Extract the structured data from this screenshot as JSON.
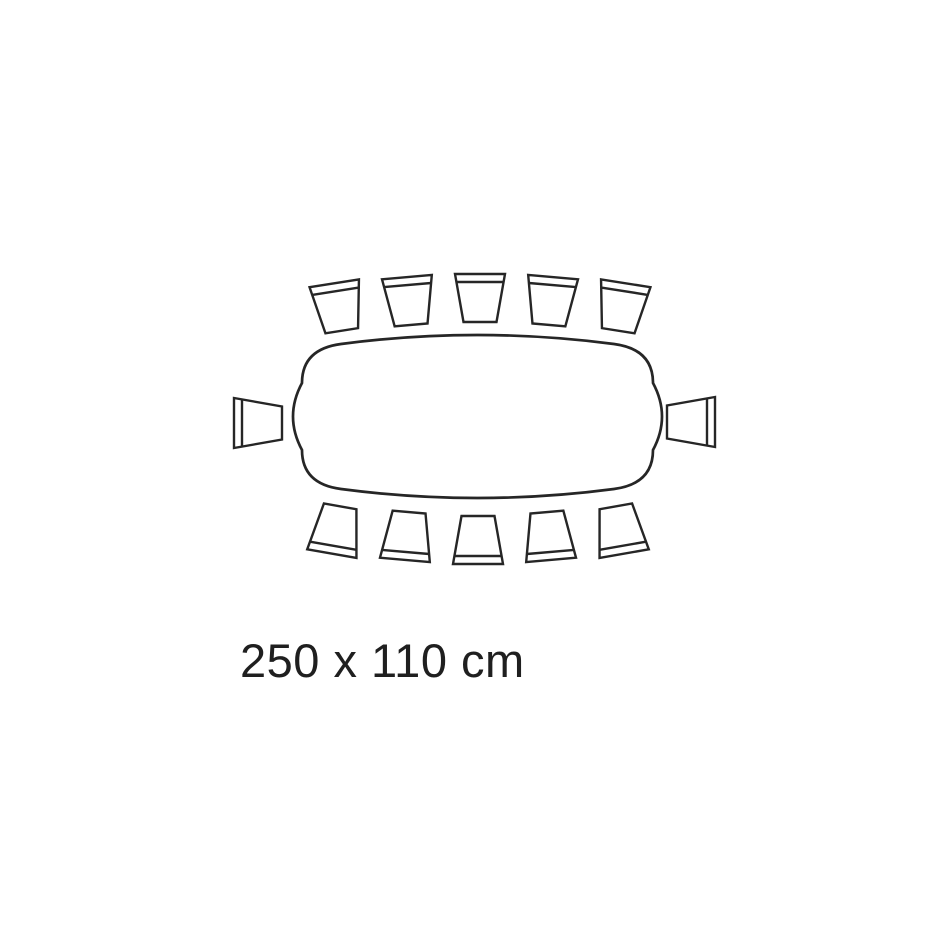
{
  "page": {
    "background": "#ffffff"
  },
  "diagram": {
    "kind": "table-seating-plan-top-view",
    "label": "250 x 110 cm",
    "table_dimensions": {
      "width_cm": 250,
      "depth_cm": 110
    },
    "seat_count": 12,
    "stroke_color": "#262626",
    "fill_color": "#ffffff",
    "table_stroke_width": 2.7,
    "chair_stroke_width": 2.4,
    "table": {
      "left": 293,
      "top": 335,
      "right": 662,
      "bottom": 498,
      "corner_radius": 48,
      "edge_bulge": 9
    },
    "chair": {
      "back_width": 50,
      "front_width": 33,
      "depth": 48,
      "back_band_offset": 8
    },
    "chairs": [
      {
        "id": "top-1",
        "cx": 338,
        "cy": 307,
        "facing": "down",
        "tilt": -9
      },
      {
        "id": "top-2",
        "cx": 409,
        "cy": 301,
        "facing": "down",
        "tilt": -5
      },
      {
        "id": "top-3",
        "cx": 480,
        "cy": 298,
        "facing": "down",
        "tilt": 0
      },
      {
        "id": "top-4",
        "cx": 551,
        "cy": 301,
        "facing": "down",
        "tilt": 5
      },
      {
        "id": "top-5",
        "cx": 622,
        "cy": 307,
        "facing": "down",
        "tilt": 9
      },
      {
        "id": "left",
        "cx": 258,
        "cy": 423,
        "facing": "right",
        "tilt": 0
      },
      {
        "id": "right",
        "cx": 691,
        "cy": 422,
        "facing": "left",
        "tilt": 0
      },
      {
        "id": "bottom-1",
        "cx": 336,
        "cy": 530,
        "facing": "up",
        "tilt": 10
      },
      {
        "id": "bottom-2",
        "cx": 407,
        "cy": 536,
        "facing": "up",
        "tilt": 5
      },
      {
        "id": "bottom-3",
        "cx": 478,
        "cy": 540,
        "facing": "up",
        "tilt": 0
      },
      {
        "id": "bottom-4",
        "cx": 549,
        "cy": 536,
        "facing": "up",
        "tilt": -5
      },
      {
        "id": "bottom-5",
        "cx": 620,
        "cy": 530,
        "facing": "up",
        "tilt": -10
      }
    ]
  }
}
